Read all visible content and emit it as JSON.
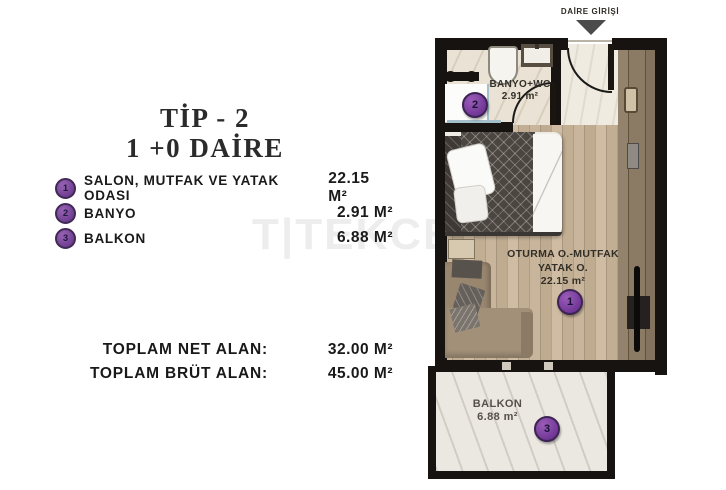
{
  "colors": {
    "badge_purple": "#7a4596",
    "wall_black": "#171310",
    "wood_floor": "#c3b096",
    "wardrobe_brown": "#8b7a64",
    "marble_light": "#eae2d4",
    "arrow_gray": "#4b4b4b"
  },
  "panel": {
    "title_line1": "TİP - 2",
    "title_line2": "1 +0 DAİRE",
    "legend": [
      {
        "num": "1",
        "label": "SALON, MUTFAK VE YATAK ODASI",
        "value": "22.15 M²"
      },
      {
        "num": "2",
        "label": "BANYO",
        "value": "2.91 M²"
      },
      {
        "num": "3",
        "label": "BALKON",
        "value": "6.88 M²"
      }
    ],
    "totals": [
      {
        "label": "TOPLAM NET ALAN:",
        "value": "32.00 M²"
      },
      {
        "label": "TOPLAM BRÜT ALAN:",
        "value": "45.00 M²"
      }
    ],
    "watermark": "T|TEKCE"
  },
  "plan": {
    "entrance_label": "DAİRE GİRİŞİ",
    "bathroom": {
      "name": "BANYO+WC",
      "area": "2.91 m²",
      "badge": "2"
    },
    "living": {
      "name_line1": "OTURMA O.-MUTFAK",
      "name_line2": "YATAK O.",
      "area": "22.15 m²",
      "badge": "1"
    },
    "balcony": {
      "name": "BALKON",
      "area": "6.88 m²",
      "badge": "3"
    }
  }
}
